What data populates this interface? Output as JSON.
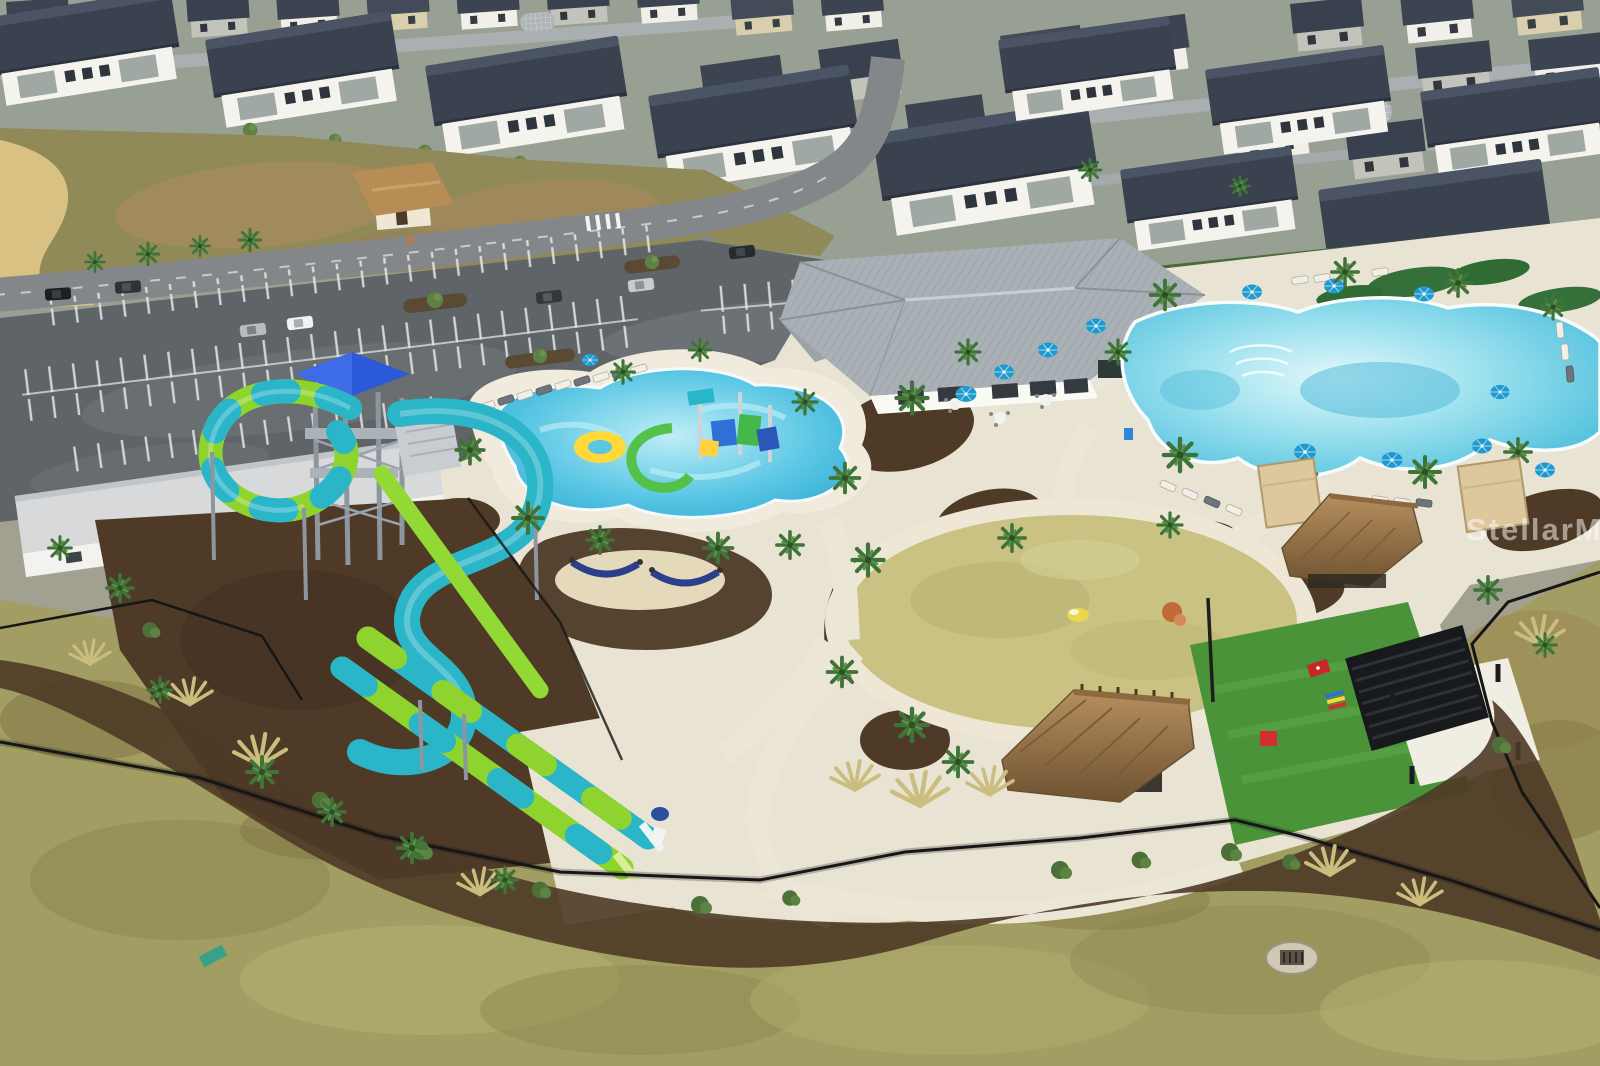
{
  "scene": {
    "type": "aerial-drone-photo",
    "subject": "Resort-style community amenity center with water park, pools, event lawn and surrounding homes on an overcast day with wet pavement",
    "watermark": "StellarMLS",
    "features": [
      "residential neighborhood of white two-story homes with dark roofs",
      "wet asphalt parking lot with white stalls and landscaped islands",
      "entry gatehouse with tan hip roof",
      "clubhouse with gray standing-seam metal roof",
      "large resort lagoon pool with blue umbrellas and loungers",
      "kids splash pool with colorful play structure",
      "water slide tower with blue canopy",
      "looping teal and lime-green water slides with twin runout lanes",
      "circular event lawn ringed by a concrete path",
      "thatched tiki huts",
      "black modern pergola on concrete pad",
      "artificial turf game lawn with red cornhole boards",
      "tan poolside cabanas",
      "hammock grove",
      "black perimeter fence with mulch landscape beds",
      "mottled berm lawn with storm drain"
    ]
  },
  "palette": {
    "roof_dark": "#3a4250",
    "walls_white": "#f4f3ee",
    "asphalt": "#63686c",
    "pool_water": "#5cc6e0",
    "slide_teal": "#2ab5c8",
    "slide_green": "#8fd42e",
    "canopy_blue": "#2b59d8",
    "umbrella_blue": "#1f9ad0",
    "lawn_circle": "#c9c283",
    "games_turf": "#4a9338",
    "thatch": "#9a7a4e",
    "deck": "#e9e3d4",
    "mulch": "#4e3a26",
    "berm_grass": "#a29d62",
    "watermark_color": "#ffffff"
  }
}
